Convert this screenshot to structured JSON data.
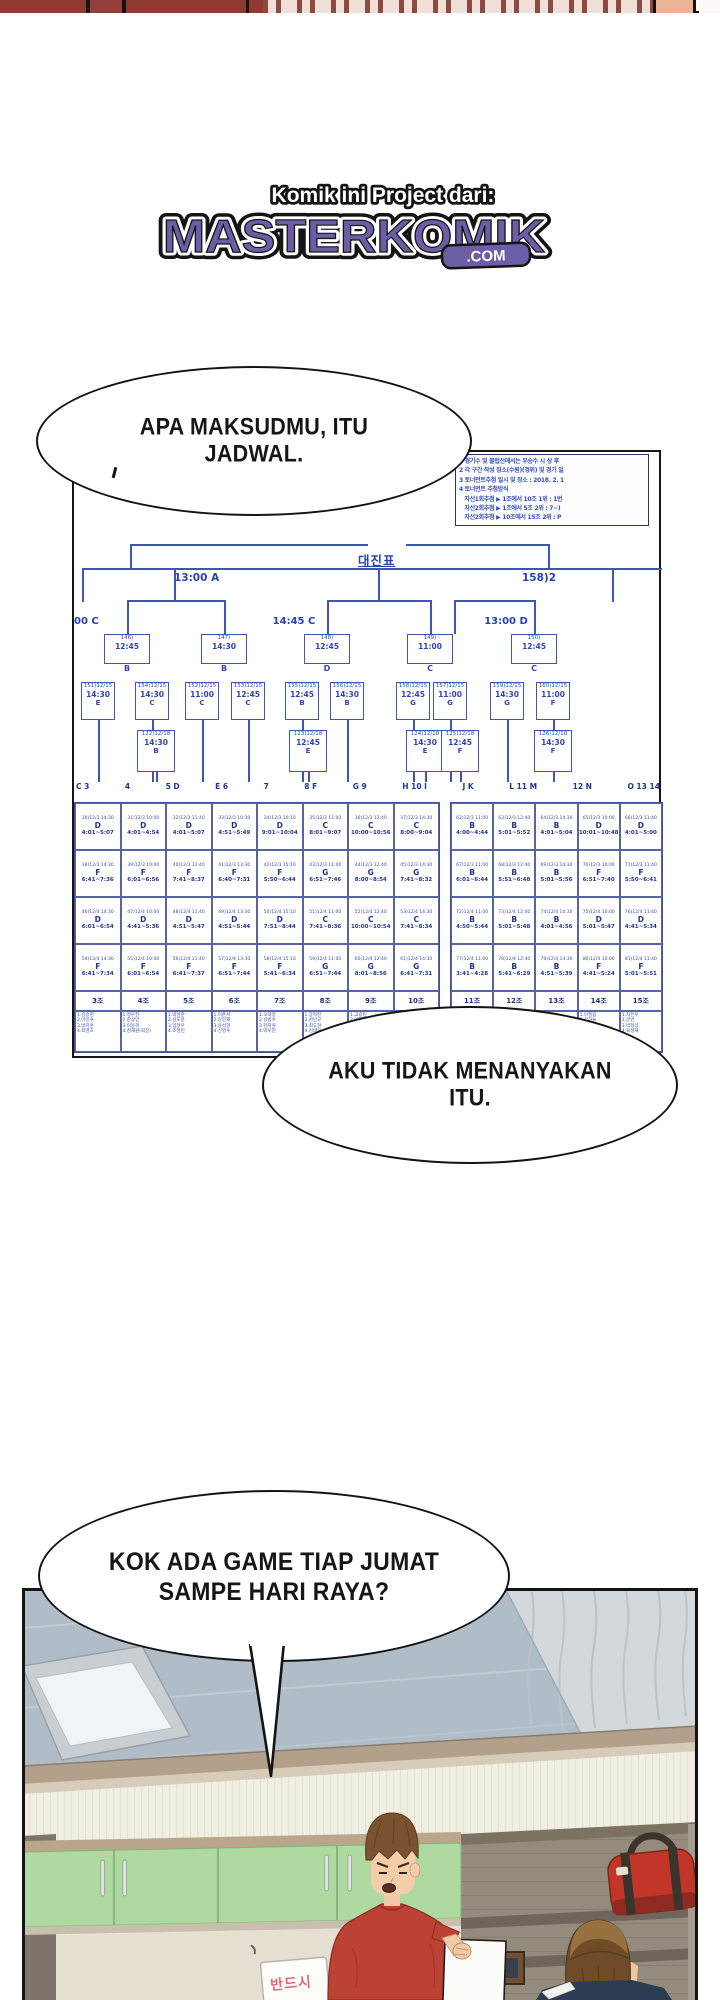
{
  "logo": {
    "banner": "Komik ini Project dari:",
    "title": "MASTERKOMIK",
    "tld": ".COM",
    "purple": "#6d5da6"
  },
  "bubble1": {
    "line1": "APA MAKSUDMU, ITU",
    "line2": "JADWAL."
  },
  "bubble2": {
    "line1": "AKU TIDAK MENANYAKAN",
    "line2": "ITU."
  },
  "bubble3": {
    "line1": "KOK ADA GAME TIAP JUMAT",
    "line2": "SAMPE HARI RAYA?"
  },
  "schedule_doc": {
    "title": "대진표",
    "info_lines": [
      "1 경기수 및 클럽선에서는 우승수 시 상 후",
      "2 각 구간 작성 장소(수원)(경위) 및 경기 일",
      "3 토너먼트추첨 일시 및 장소 : 2018. 2. 1",
      "4 토너먼트 추첨방식",
      "   자선1회추첨 ▶ 1조에서 10조 1위 : 1번",
      "   자선2회추첨 ▶ 1조에서 5조 2위 : 7~)",
      "   자선2회추첨 ▶ 10조에서 15조 2위 : P"
    ],
    "final_label_left": "13:00 A",
    "final_label_right": "158)2",
    "semi_labels": [
      "00 C",
      "14:45 C",
      "13:00 D"
    ],
    "round1_boxes": [
      {
        "num": "146)",
        "time": "12:45",
        "letter": "B"
      },
      {
        "num": "147)",
        "time": "14:30",
        "letter": "B"
      },
      {
        "num": "148)",
        "time": "12:45",
        "letter": "D"
      },
      {
        "num": "149)",
        "time": "11:00",
        "letter": "C"
      },
      {
        "num": "150)",
        "time": "12:45",
        "letter": "C"
      }
    ],
    "round2_boxes": [
      {
        "num": "151)12/15",
        "time": "14:30",
        "letter": "E"
      },
      {
        "num": "154)12/15",
        "time": "14:30",
        "letter": "C"
      },
      {
        "num": "152)12/15",
        "time": "11:00",
        "letter": "C"
      },
      {
        "num": "153)12/15",
        "time": "12:45",
        "letter": "C"
      },
      {
        "num": "155)12/15",
        "time": "12:45",
        "letter": "B"
      },
      {
        "num": "156)12/15",
        "time": "14:30",
        "letter": "B"
      },
      {
        "num": "158)12/15",
        "time": "12:45",
        "letter": "G"
      },
      {
        "num": "157)12/15",
        "time": "11:00",
        "letter": "G"
      },
      {
        "num": "159)12/15",
        "time": "14:30",
        "letter": "G"
      },
      {
        "num": "160)12/15",
        "time": "11:00",
        "letter": "F"
      }
    ],
    "round3_boxes": [
      {
        "num": "122)12/18",
        "time": "14:30",
        "letter": "B"
      },
      {
        "num": "123)12/18",
        "time": "12:45",
        "letter": "E"
      },
      {
        "num": "124)12/18",
        "time": "14:30",
        "letter": "E"
      },
      {
        "num": "125)12/18",
        "time": "12:45",
        "letter": "F"
      },
      {
        "num": "126)12/18",
        "time": "14:30",
        "letter": "F"
      }
    ],
    "leaf_tokens": [
      "C 3",
      "4",
      "5 D",
      "E 6",
      "7",
      "8 F",
      "G 9",
      "H 10 I",
      "J K",
      "L 11 M",
      "12 N",
      "O 13 14"
    ],
    "table": {
      "group_headers_left": [
        "3조",
        "4조",
        "5조",
        "6조",
        "7조",
        "8조",
        "9조",
        "10조"
      ],
      "group_headers_right": [
        "11조",
        "12조",
        "13조",
        "14조",
        "15조"
      ],
      "rows_left": [
        [
          "30)12/3 14:30|D|4:01~5:07",
          "31)12/3 10:00|D|4:01~4:54",
          "32)12/3 11:40|D|4:01~5:07",
          "33)12/3 10:30|D|4:51~5:49",
          "34)12/3 10:10|D|9:01~10:04",
          "35)12/3 11:00|C|8:01~9:07",
          "36)12/3 12:40|C|10:00~10:56",
          "37)12/3 14:30|C|8:00~9:04"
        ],
        [
          "38)12/3 14:30|F|6:41~7:36",
          "39)12/3 10:00|F|6:01~6:56",
          "40)12/3 11:40|F|7:41~8:37",
          "41)12/3 13:30|F|6:40~7:31",
          "42)12/3 15:10|F|5:50~6:44",
          "43)12/3 11:00|G|6:51~7:46",
          "44)12/3 12:40|G|8:00~8:54",
          "45)12/3 14:30|G|7:41~8:32"
        ],
        [
          "46)12/4 14:30|D|6:01~6:54",
          "47)12/4 10:00|D|4:41~5:36",
          "48)12/4 11:40|D|4:51~5:47",
          "49)12/4 13:30|D|4:51~5:44",
          "50)12/4 15:10|D|7:51~8:44",
          "51)12/4 11:00|C|7:41~8:36",
          "52)12/4 12:40|C|10:00~10:54",
          "53)12/4 14:30|C|7:41~8:34"
        ],
        [
          "54)12/4 14:30|F|6:41~7:34",
          "55)12/4 10:00|F|6:01~6:54",
          "56)12/4 11:40|F|6:41~7:37",
          "57)12/4 13:30|F|6:51~7:44",
          "58)12/4 15:10|F|5:41~6:34",
          "59)12/4 11:00|G|6:51~7:44",
          "60)12/4 12:40|G|8:01~8:56",
          "61)12/4 14:30|G|6:41~7:31"
        ]
      ],
      "rows_right": [
        [
          "62)12/3 11:00|B|4:00~4:44",
          "63)12/3 12:40|B|5:01~5:52",
          "64)12/3 14:30|B|4:01~5:04",
          "65)12/3 10:00|D|10:01~10:48",
          "66)12/3 11:40|D|4:01~5:00"
        ],
        [
          "67)12/3 11:00|B|6:01~6:44",
          "68)12/3 12:40|B|5:51~6:48",
          "69)12/3 14:30|B|5:01~5:56",
          "70)12/3 10:00|F|6:51~7:40",
          "71)12/3 11:40|F|5:50~6:41"
        ],
        [
          "72)12/4 11:00|B|4:50~5:44",
          "73)12/4 12:40|B|5:01~5:48",
          "74)12/4 14:30|B|4:01~4:56",
          "75)12/4 10:00|D|5:01~5:47",
          "76)12/4 11:40|D|4:41~5:34"
        ],
        [
          "77)12/4 11:00|B|3:41~4:28",
          "78)12/4 12:40|B|5:41~6:29",
          "79)12/4 14:30|B|4:51~5:39",
          "80)12/4 10:00|F|4:41~5:24",
          "81)12/4 11:40|F|5:01~5:51"
        ]
      ],
      "names_left": [
        "1.김승현|2.이민수|3.박지훈|4.최영호",
        "1.정우진|2.한상민|3.이동혁|4.김재원(회장)",
        "1.박성준|2.김도윤|3.임현우|4.조성민",
        "1.이준서|2.강민재|3.윤석현|4.신영수",
        "1.오태양|2.김범수|3.한지원|4.박우진",
        "1.장혁진|2.서민규|3.최도현|4.김태우",
        "1.고승민|2.이재혁|3.문성우|4.정해인",
        "1.배정남|2.유승호|3.김우빈|4.나인우"
      ],
      "names_right": [
        "1.최민호|2.김진우|3.이상혁|4.박태환",
        "1.송민국|2.전정국|3.김석진|4.박하람",
        "1.임시완|2.도경수|3.변백현|4.김종인",
        "1.이필립|2.강하늘|3.주지훈|4.정일우",
        "1.차은우|2.문빈|3.박형식|4.육성재"
      ]
    }
  },
  "bottom_panel": {
    "sign_text": "반드시"
  }
}
